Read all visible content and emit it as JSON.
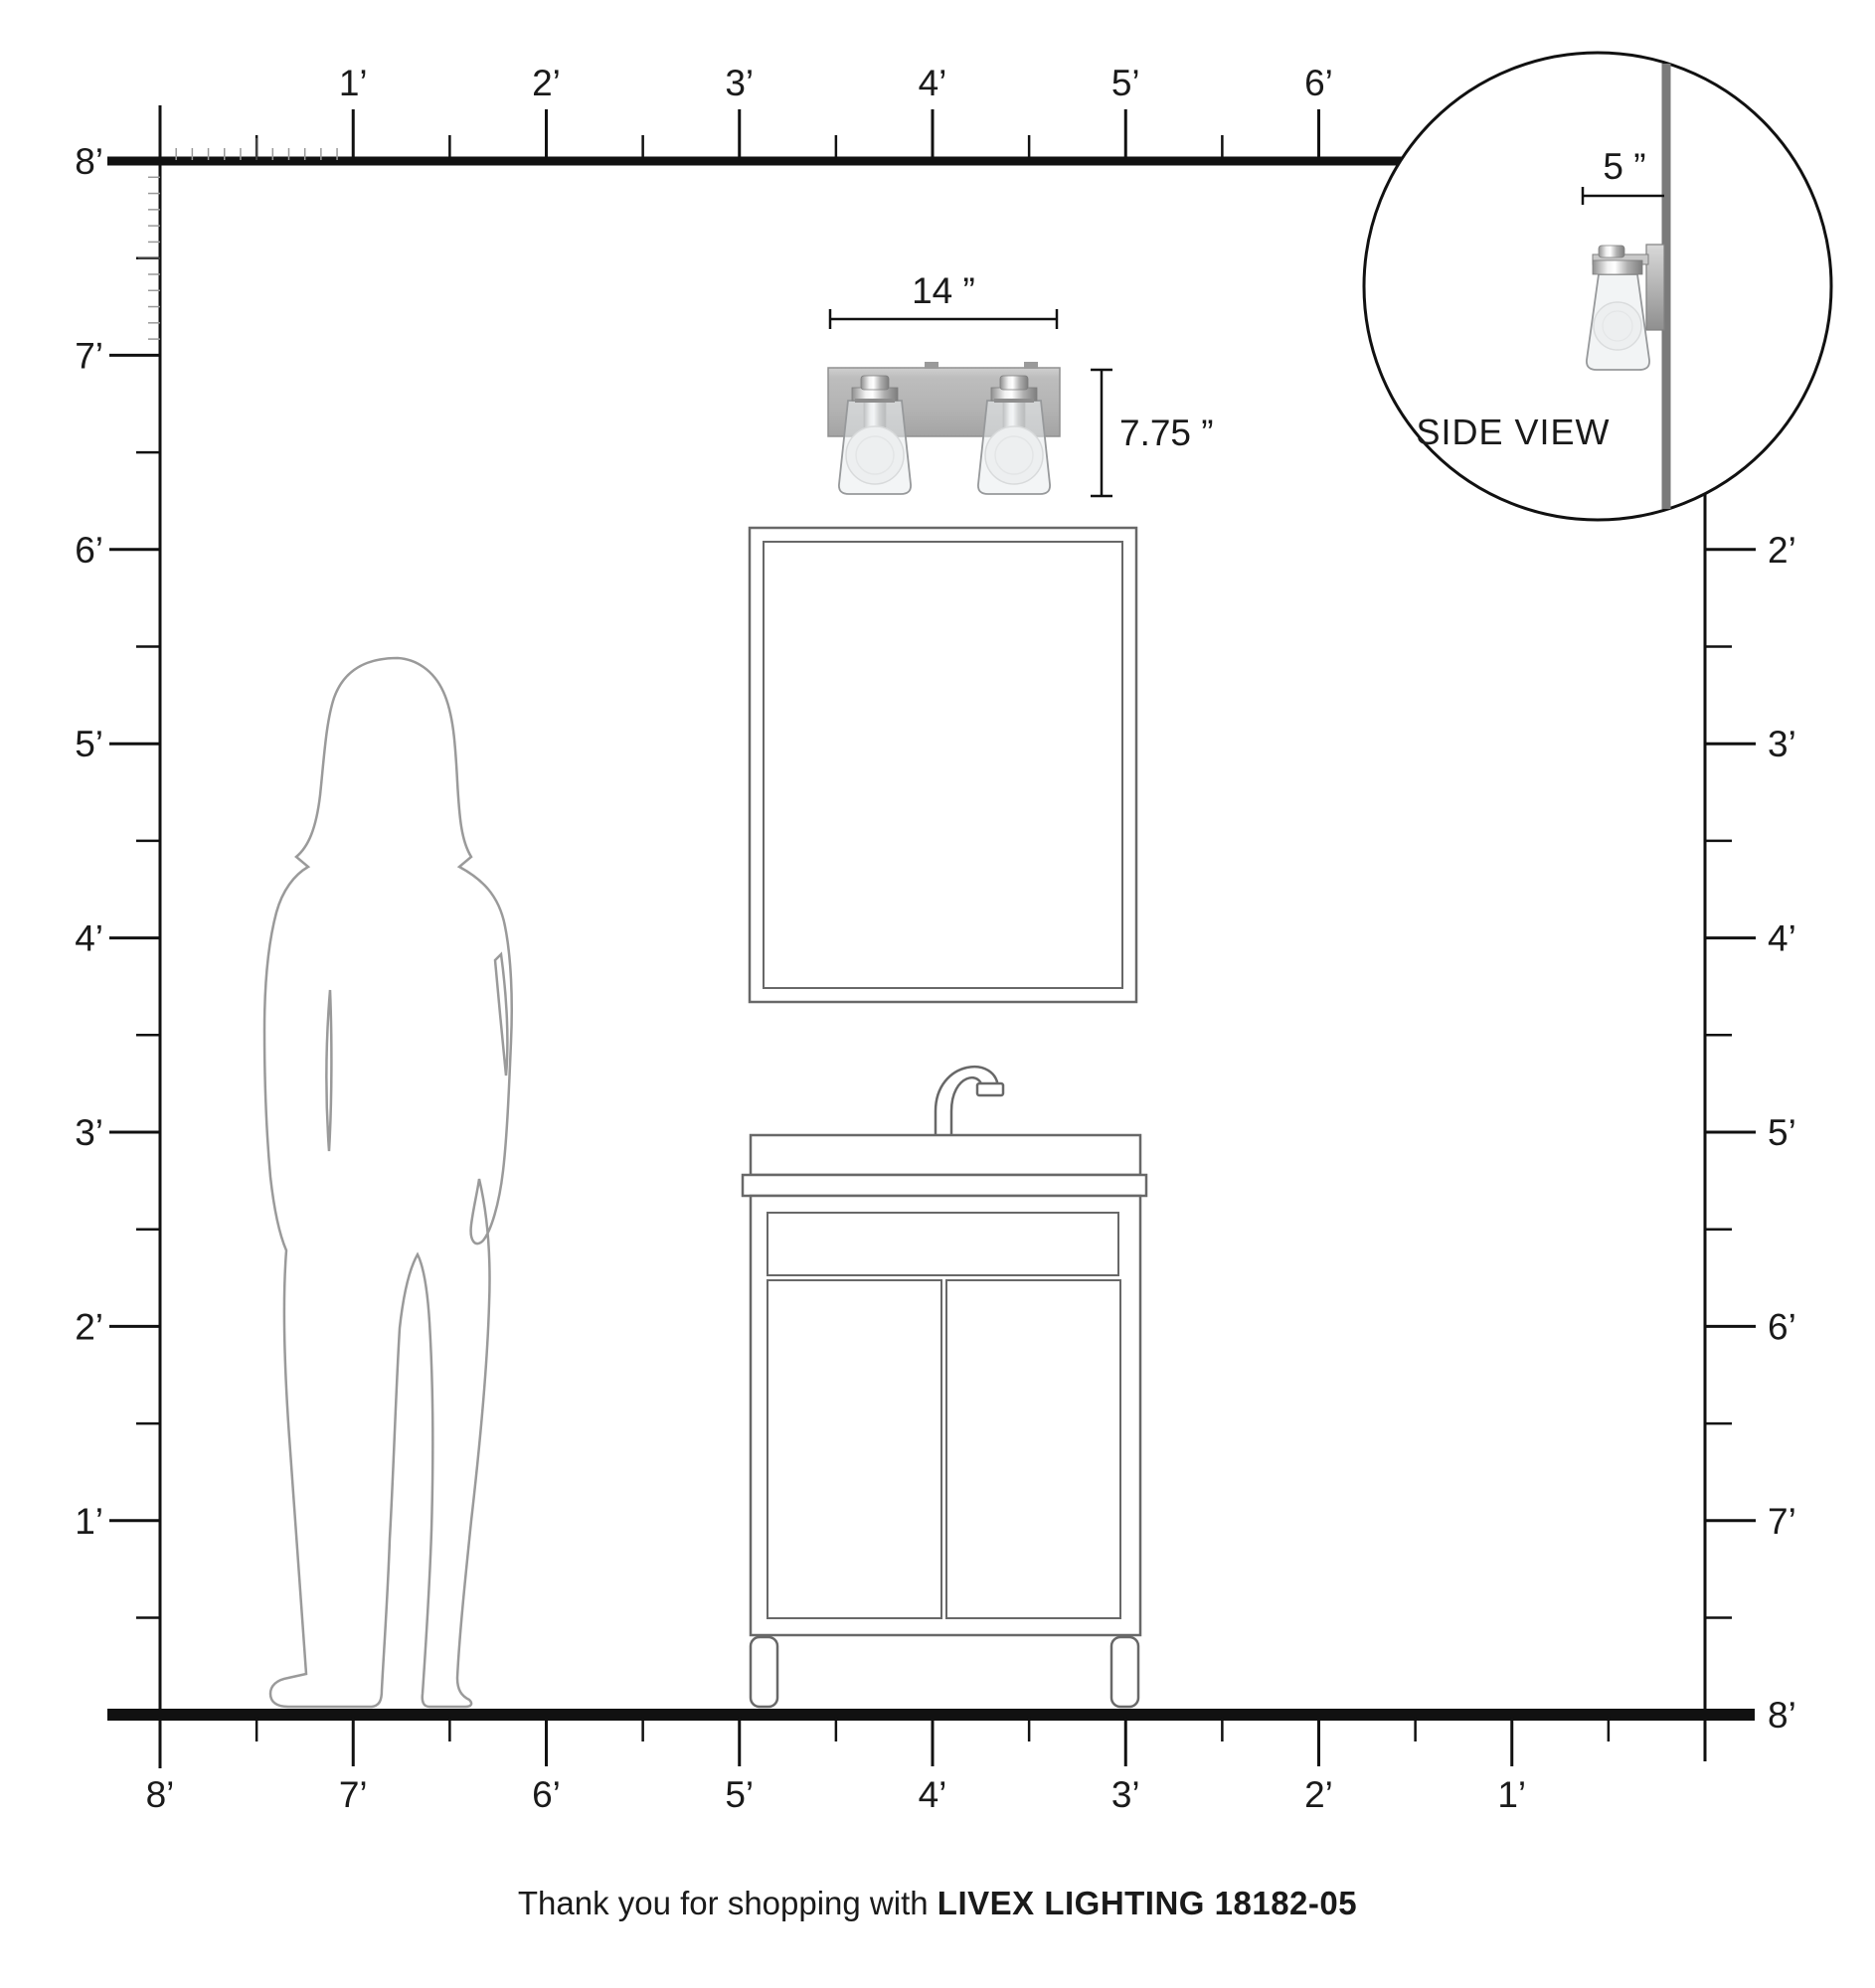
{
  "rulers": {
    "top": {
      "labels": [
        "1’",
        "2’",
        "3’",
        "4’",
        "5’",
        "6’"
      ]
    },
    "left": {
      "labels": [
        "8’",
        "7’",
        "6’",
        "5’",
        "4’",
        "3’",
        "2’",
        "1’"
      ]
    },
    "right": {
      "labels": [
        "2’",
        "3’",
        "4’",
        "5’",
        "6’",
        "7’",
        "8’"
      ]
    },
    "bottom": {
      "labels": [
        "8’",
        "7’",
        "6’",
        "5’",
        "4’",
        "3’",
        "2’",
        "1’"
      ]
    }
  },
  "dimensions": {
    "width_label": "14 ”",
    "height_label": "7.75 ”",
    "depth_label": "5 ”"
  },
  "inset": {
    "label": "SIDE VIEW"
  },
  "footer": {
    "prefix": "Thank you for shopping with ",
    "brand": "LIVEX LIGHTING 18182-05"
  },
  "colors": {
    "line": "#111111",
    "outline": "#686868",
    "figure": "#9a9a9a",
    "wall": "#7a7a7a",
    "backplate": "#b3b3b3"
  }
}
